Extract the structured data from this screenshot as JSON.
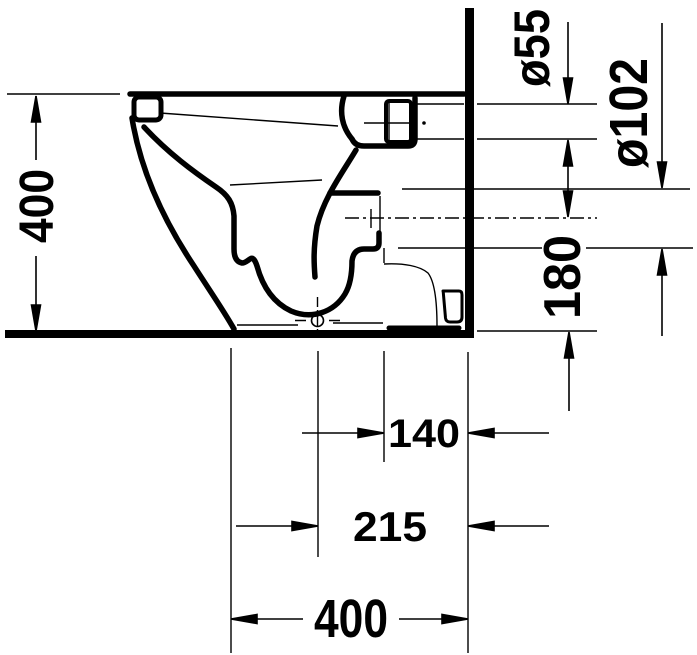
{
  "drawing": {
    "kind": "technical-dimension-drawing",
    "subject": "floor-standing toilet, side elevation against wall",
    "units": "mm",
    "labels": {
      "height": "400",
      "spigot_diameter": "ø55",
      "outlet_diameter": "ø102",
      "outlet_axis_height": "180",
      "outlet_axis_to_wall": "140",
      "drain_center_to_wall": "215",
      "depth": "400"
    },
    "colors": {
      "line": "#000000",
      "background": "#ffffff"
    }
  }
}
